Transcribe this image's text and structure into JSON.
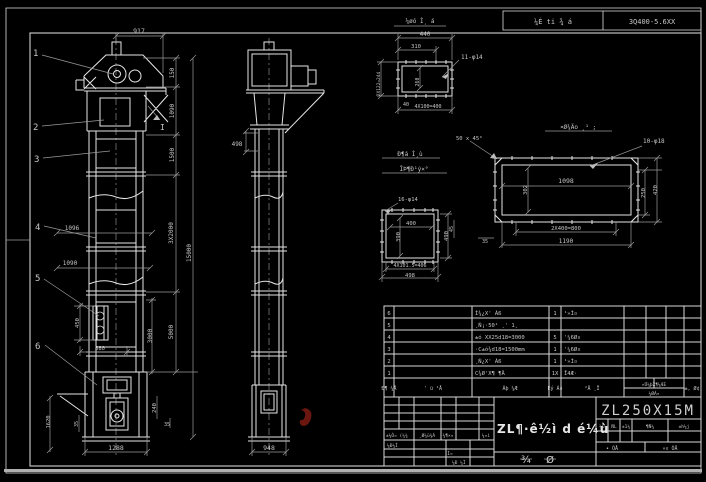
{
  "canvas": {
    "bg": "#000000",
    "line": "#e6e6e6",
    "dim_line": "#9a9a9a",
    "text": "#c6c6c6",
    "red_mark": "#6b1710"
  },
  "header_strip": {
    "left_cell": "¼É ti ¾ á",
    "right_cell": "3Q400-5.6XX"
  },
  "front_view": {
    "callouts": [
      "1",
      "2",
      "3",
      "4",
      "5",
      "6"
    ],
    "section_mark": "I",
    "dims": {
      "top_width": "917",
      "head_150": "150",
      "upper_1090": "1090",
      "neck_1500": "1500",
      "sections_3x2000": "3X2000",
      "mid_5000": "5000",
      "total_15000": "15000",
      "width_1096": "1096",
      "width_1090": "1090",
      "chain_450": "450",
      "chain_580": "580",
      "boot_3000": "3000",
      "boot_1620": "1620",
      "boot_35": "35",
      "right_240": "240",
      "right_35": "35",
      "base_1288": "1288"
    }
  },
  "side_view": {
    "dims": {
      "flange_498": "498",
      "base_948": "948"
    }
  },
  "inlet_flange": {
    "title": "¼øó Ì¸ á",
    "holes": "11-φ14",
    "dims": {
      "width_440": "440",
      "width_310": "310",
      "height_2x122": "2X122=244",
      "inner_260": "260",
      "edge_40": "40",
      "pitch_4x100": "4X100=400"
    }
  },
  "square_flange": {
    "label1": "Ð¶á Ì¸ù",
    "label2": "ÎÞ¶Ð¹ý×°",
    "holes": "16-φ14",
    "dims": {
      "inner_400": "400",
      "inner_390": "390",
      "height_490": "490",
      "pitch": "4X101.5=406",
      "width_498": "498"
    }
  },
  "discharge_flange": {
    "title": "¤Ø¾Äo ¸¹ ;",
    "chamfer": "50 x 45°",
    "holes": "10-φ18",
    "dims": {
      "inner_1098": "1098",
      "inner_302": "302",
      "height_250": "250",
      "height_420": "420",
      "pitch_2x400": "2X400=800",
      "width_1190": "1190",
      "gap_45": "45",
      "gap_35": "35"
    }
  },
  "parts_table": {
    "header": {
      "no": "Ð¶ ¼Å",
      "code": "' ü ¹Å",
      "name": "Ãþ ¼Æ",
      "qty": "Êý Á¤",
      "material": "²Ä ¸Ï",
      "weight_top": "«Ü¼þX¶¼ÆE",
      "weight_bottom": "¼ØÁ¤",
      "remark": "±, Ø¢"
    },
    "rows": [
      {
        "no": "6",
        "code": "",
        "name": "Ì¾¿X' Áß",
        "qty": "1",
        "material": "¹»Ì¤",
        "remark": ""
      },
      {
        "no": "5",
        "code": "",
        "name": "¸Ñ¡·50¹ ¸' 1¸",
        "qty": "",
        "material": "",
        "remark": ""
      },
      {
        "no": "4",
        "code": "",
        "name": "±ó XX25d18=3000",
        "qty": "5",
        "material": "'¼6Ø¤",
        "remark": ""
      },
      {
        "no": "3",
        "code": "",
        "name": "·C±ó¾d18=1500mm",
        "qty": "1",
        "material": "'¼6Ø¤",
        "remark": ""
      },
      {
        "no": "2",
        "code": "",
        "name": "¸Ñ¿X' Áß",
        "qty": "1",
        "material": "¹»Ì¤",
        "remark": ""
      },
      {
        "no": "1",
        "code": "",
        "name": "C¾Ø'X¶ ¶Ä",
        "qty": "1X",
        "material": "Î4Æ·",
        "remark": ""
      }
    ]
  },
  "title_block": {
    "drawing_title": "ZL¶·ê½ì d é¼ù",
    "model": "ZL250X15M",
    "stage_cells": [
      "¼Ð",
      "ÑL",
      "±1¼",
      "¶Ñ¼",
      "±h¼j"
    ],
    "sheet_left": "• ÕÅ",
    "sheet_right": "»¤ ÕÅ",
    "rev_row": [
      "±¼Ô¤ (¼¾",
      "¸Ø¼ü¾Á",
      "¼¶×¤",
      "¼¤ì"
    ],
    "sign1": "¼Ð¼Ì",
    "sign2": "Ì¤",
    "sign3": "¼Ð ¼Ì",
    "stamps": [
      "¾",
      "Ø"
    ]
  }
}
